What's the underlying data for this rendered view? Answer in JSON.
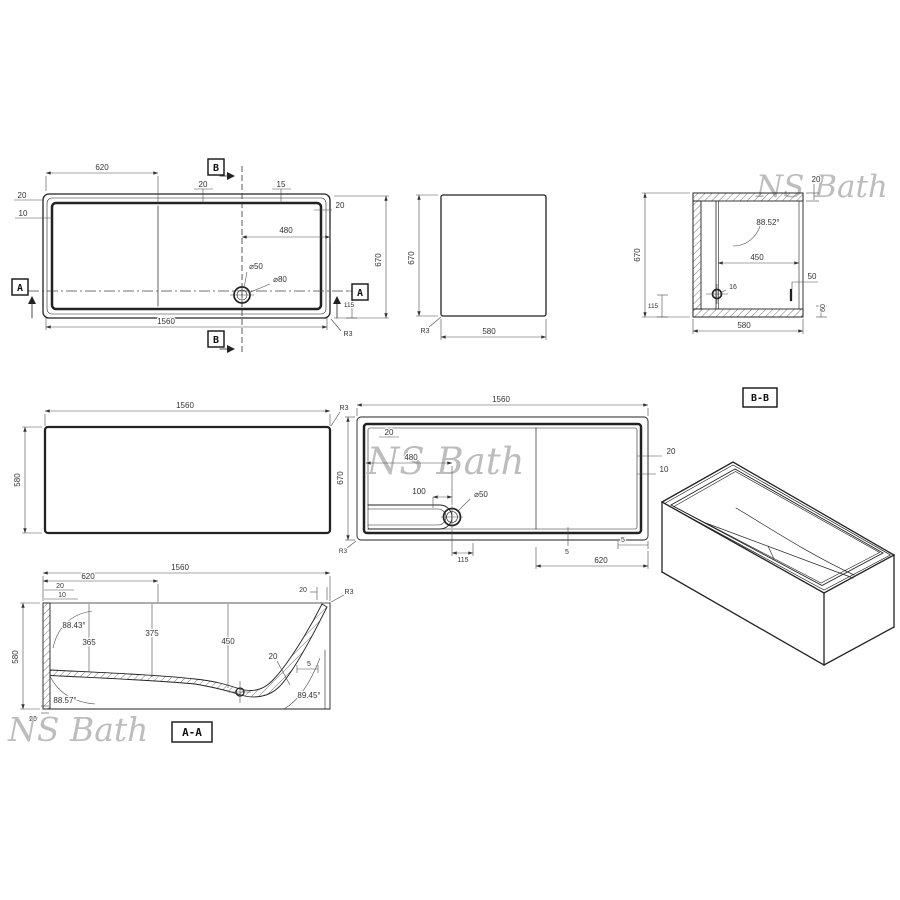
{
  "watermark": {
    "text": "NS Bath",
    "color": "#bdbdbd"
  },
  "colors": {
    "line": "#222222",
    "dim_text": "#3c3c3c",
    "background": "#ffffff"
  },
  "plan_view": {
    "marker_a": "A",
    "marker_b": "B",
    "dim_620": "620",
    "dim_20_top": "20",
    "dim_15": "15",
    "dim_20_left": "20",
    "dim_10_left": "10",
    "dim_20_right": "20",
    "dim_480": "480",
    "drain_dia_50": "⌀50",
    "drain_dia_80": "⌀80",
    "dim_670": "670",
    "dim_1560": "1560",
    "dim_115": "115",
    "radius": "R3"
  },
  "front_view": {
    "dim_670": "670",
    "dim_580": "580",
    "radius": "R3"
  },
  "section_bb": {
    "label": "B-B",
    "dim_20": "20",
    "angle": "88.52°",
    "dim_450": "450",
    "dim_16": "16",
    "dim_50": "50",
    "dim_60": "60",
    "dim_670": "670",
    "dim_115": "115",
    "dim_580": "580"
  },
  "side_view": {
    "dim_1560": "1560",
    "dim_580": "580",
    "radius": "R3"
  },
  "bottom_view": {
    "dim_1560": "1560",
    "dim_670": "670",
    "dim_20_top": "20",
    "dim_480": "480",
    "dim_100": "100",
    "drain_dia_50": "⌀50",
    "dim_115": "115",
    "dim_5_left": "5",
    "dim_5_right": "5",
    "dim_620": "620",
    "dim_20_right": "20",
    "dim_10_right": "10",
    "radius": "R3"
  },
  "section_aa": {
    "label": "A-A",
    "dim_1560": "1560",
    "dim_620": "620",
    "dim_20_top_left": "20",
    "dim_10_top_left": "10",
    "dim_20_top_right": "20",
    "radius": "R3",
    "angle_top_left": "88.43°",
    "dim_365": "365",
    "dim_375": "375",
    "dim_450": "450",
    "dim_20_floor": "20",
    "dim_5": "5",
    "dim_580": "580",
    "angle_bottom_left": "88.57°",
    "angle_bottom_right": "89.45°",
    "dim_20_bottom_left": "20"
  }
}
